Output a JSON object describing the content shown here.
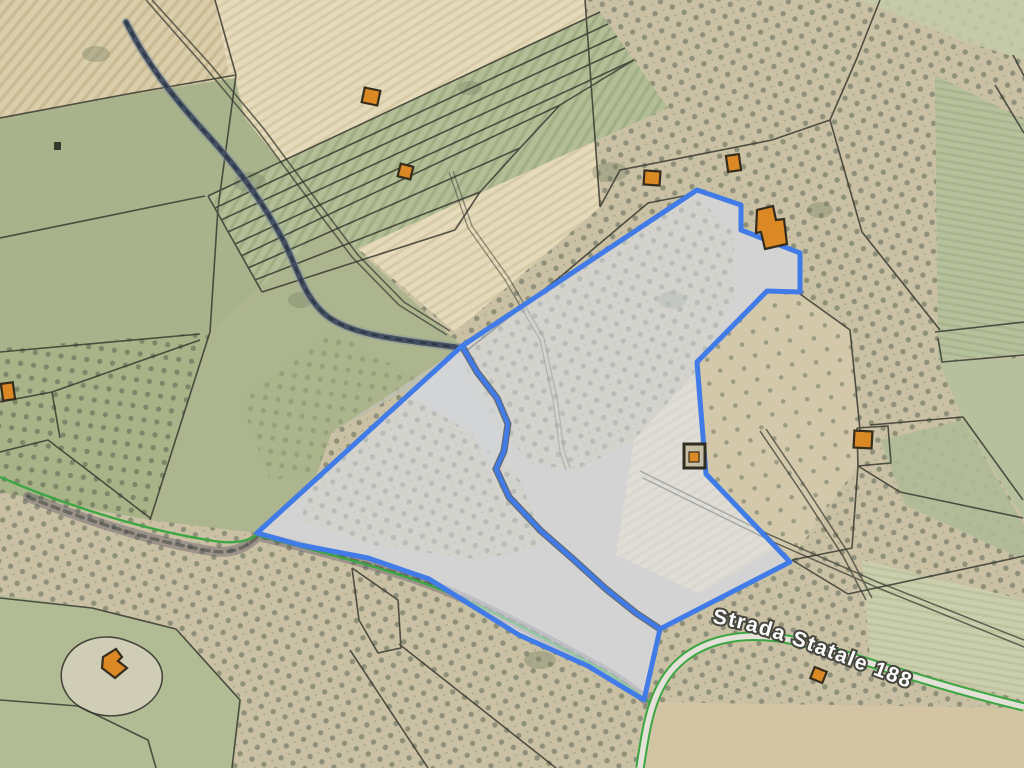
{
  "map": {
    "type": "cadastral-parcel-selection-over-satellite",
    "road_label": "Strada Statale 188",
    "colors": {
      "selection": "#3b7bf0",
      "selection_fill": "rgba(223,229,242,0.55)",
      "selection_base": "#cbc3b0",
      "divider_dark": "#3b4554",
      "building_fill": "#e2891c",
      "building_stroke": "#33291a",
      "road_green": "#36a93d",
      "road_fill": "#e7e5da",
      "parcel_line": "#32322a",
      "stream": "#39465c"
    },
    "selected_parcel": {
      "outer": [
        [
          697,
          190
        ],
        [
          741,
          205
        ],
        [
          741,
          230
        ],
        [
          800,
          253
        ],
        [
          800,
          292
        ],
        [
          767,
          291
        ],
        [
          697,
          362
        ],
        [
          706,
          474
        ],
        [
          790,
          562
        ],
        [
          660,
          629
        ],
        [
          644,
          700
        ],
        [
          588,
          666
        ],
        [
          519,
          635
        ],
        [
          474,
          607
        ],
        [
          429,
          579
        ],
        [
          368,
          558
        ],
        [
          300,
          545
        ],
        [
          257,
          533
        ],
        [
          462,
          346
        ]
      ],
      "divider": [
        [
          462,
          346
        ],
        [
          477,
          372
        ],
        [
          497,
          398
        ],
        [
          508,
          424
        ],
        [
          504,
          451
        ],
        [
          496,
          469
        ],
        [
          509,
          497
        ],
        [
          541,
          531
        ],
        [
          573,
          559
        ],
        [
          606,
          589
        ],
        [
          636,
          613
        ],
        [
          660,
          629
        ]
      ]
    },
    "buildings": [
      {
        "id": "building-1",
        "type": "rect",
        "x": 363,
        "y": 89,
        "w": 16,
        "h": 15,
        "rot": 12
      },
      {
        "id": "building-2",
        "type": "rect",
        "x": 399,
        "y": 165,
        "w": 13,
        "h": 13,
        "rot": 14
      },
      {
        "id": "building-3",
        "type": "rect",
        "x": 644,
        "y": 171,
        "w": 16,
        "h": 14,
        "rot": 4
      },
      {
        "id": "building-4",
        "type": "rect",
        "x": 727,
        "y": 155,
        "w": 13,
        "h": 16,
        "rot": -8
      },
      {
        "id": "building-5",
        "type": "poly",
        "points": [
          [
            757,
            210
          ],
          [
            773,
            206
          ],
          [
            776,
            220
          ],
          [
            784,
            219
          ],
          [
            787,
            244
          ],
          [
            765,
            249
          ],
          [
            761,
            232
          ],
          [
            756,
            233
          ]
        ]
      },
      {
        "id": "building-6",
        "type": "rect",
        "x": 854,
        "y": 431,
        "w": 18,
        "h": 17,
        "rot": 3
      },
      {
        "id": "building-7",
        "type": "rect",
        "x": 2,
        "y": 383,
        "w": 12,
        "h": 17,
        "rot": -8
      },
      {
        "id": "building-8",
        "type": "poly",
        "points": [
          [
            103,
            657
          ],
          [
            116,
            649
          ],
          [
            122,
            657
          ],
          [
            118,
            661
          ],
          [
            127,
            668
          ],
          [
            115,
            678
          ],
          [
            102,
            668
          ]
        ]
      },
      {
        "id": "building-9",
        "type": "rect",
        "x": 812,
        "y": 669,
        "w": 13,
        "h": 12,
        "rot": 22
      }
    ],
    "utility_building": {
      "outer": {
        "x": 684,
        "y": 444,
        "w": 21,
        "h": 24
      },
      "inner": {
        "x": 689,
        "y": 452,
        "w": 10,
        "h": 10
      }
    }
  }
}
